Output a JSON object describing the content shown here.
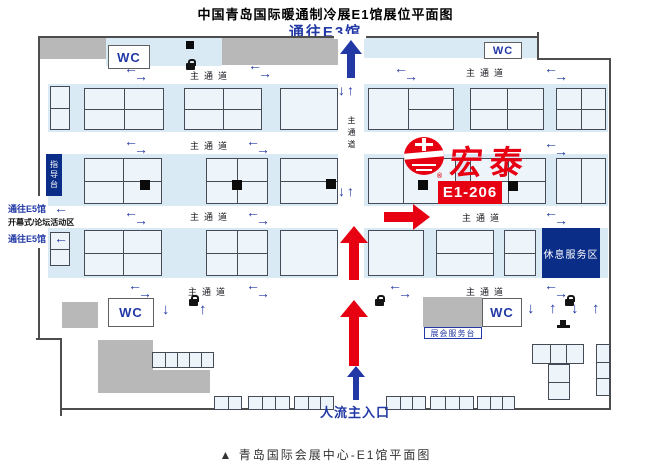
{
  "title": "中国青岛国际暖通制冷展E1馆展位平面图",
  "caption": "▲ 青岛国际会展中心-E1馆平面图",
  "nav": {
    "to_e3": "通往E3馆",
    "to_e5_upper": "通往E5馆",
    "to_e5_lower": "通往E5馆",
    "forum_area": "开幕式/论坛活动区",
    "main_entrance": "人流主入口"
  },
  "labels": {
    "wc": "WC",
    "main_aisle": "主通道",
    "rest_service_area": "休息服务区",
    "expo_service_desk": "展会服务台",
    "guide_desk": "指导台"
  },
  "exhibitor": {
    "name": "宏泰",
    "booth_no": "E1-206",
    "registered_mark": "®"
  },
  "icons": {
    "arrow_left": "←",
    "arrow_right": "→",
    "arrow_up": "↑",
    "arrow_down": "↓"
  },
  "colors": {
    "accent_blue": "#2239a5",
    "navy": "#0a2d88",
    "brand_red": "#e60012",
    "booth_strip": "#d9eaf5",
    "gray_block": "#b8b8b8",
    "wall": "#4d4d4d"
  }
}
